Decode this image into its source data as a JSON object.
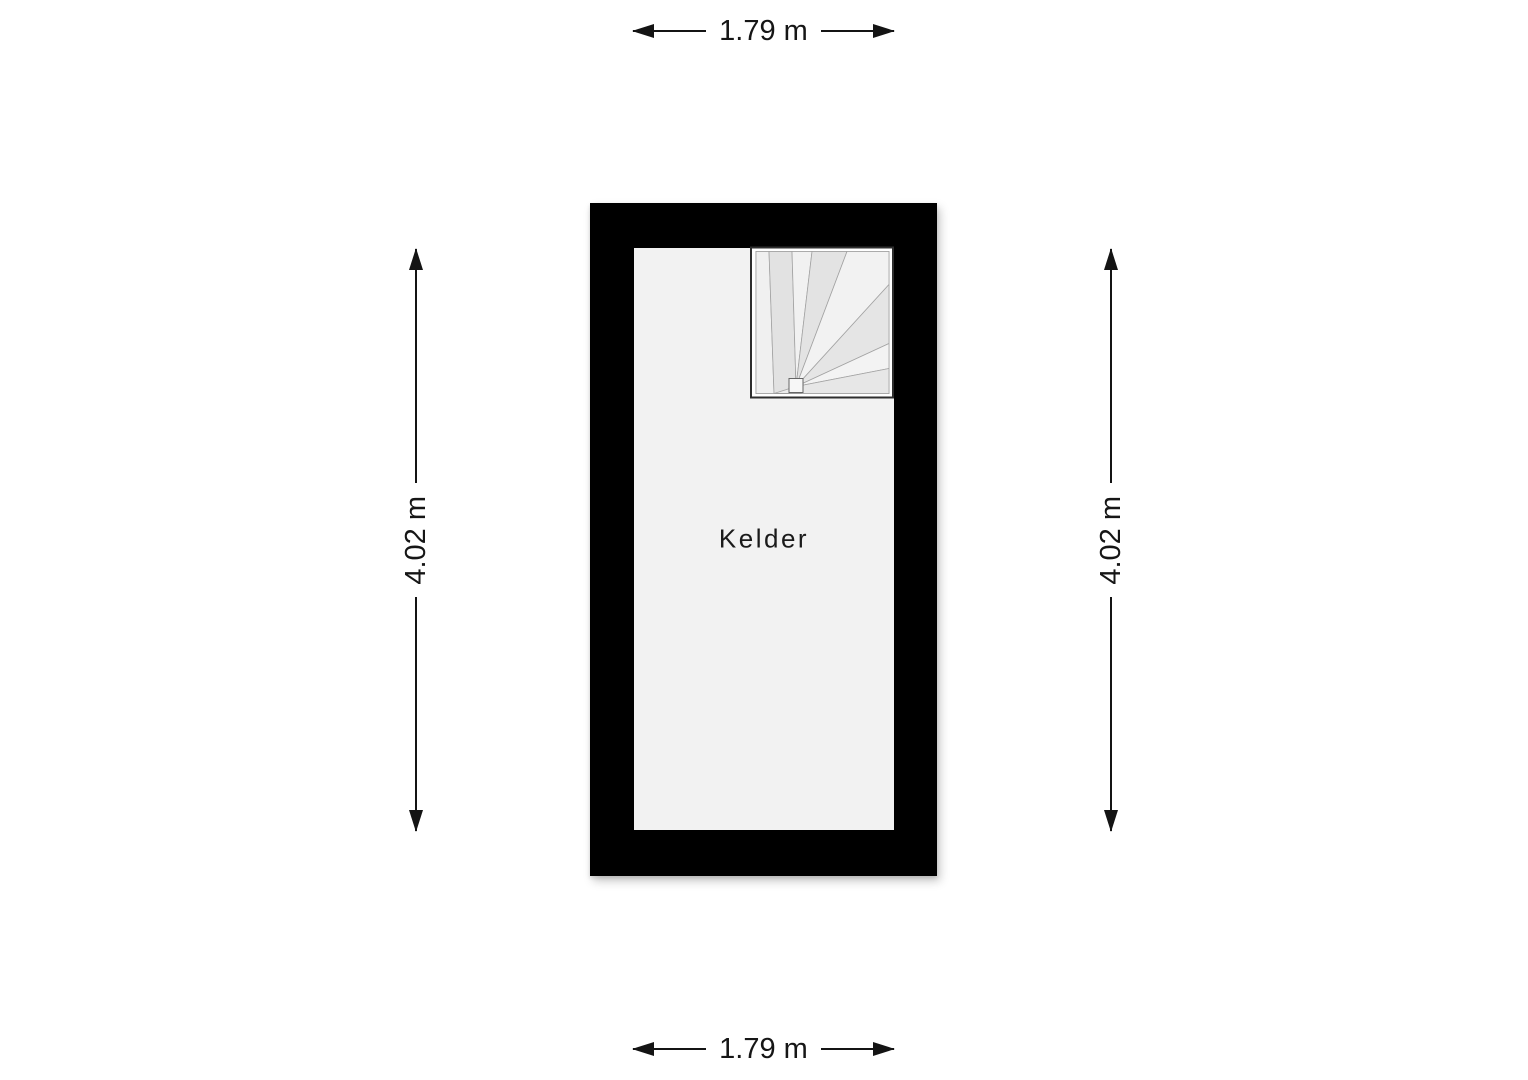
{
  "plan": {
    "room_label": "Kelder",
    "wall_color": "#000000",
    "floor_color": "#f2f2f2",
    "stair_frame_color": "#ffffff"
  },
  "dimensions": {
    "top": {
      "label": "1.79 m"
    },
    "bottom": {
      "label": "1.79 m"
    },
    "left": {
      "label": "4.02 m"
    },
    "right": {
      "label": "4.02 m"
    }
  }
}
